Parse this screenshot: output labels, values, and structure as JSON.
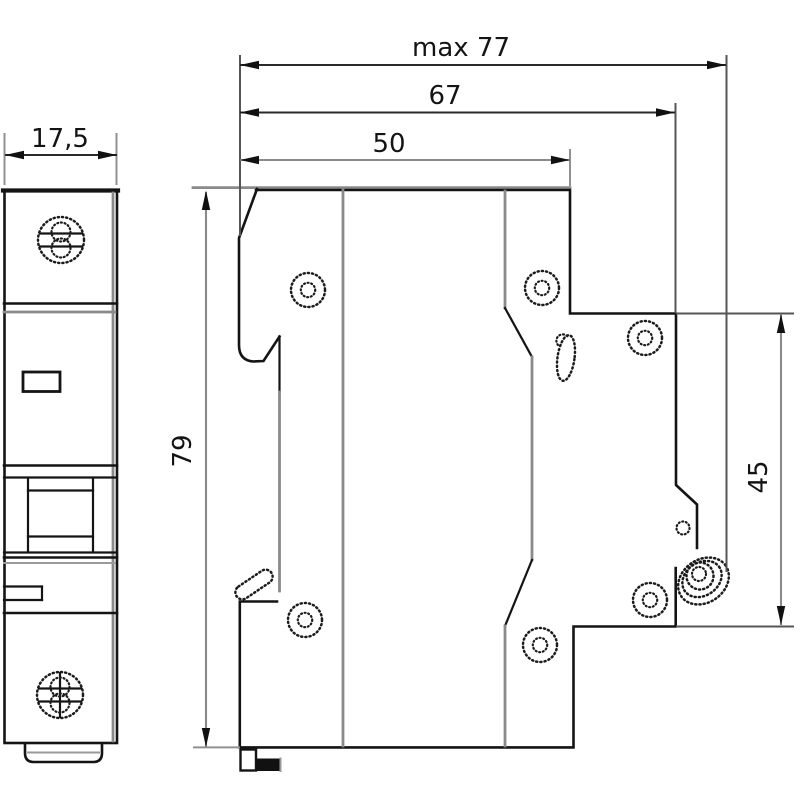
{
  "drawing": {
    "title": "Modular circuit breaker — outline and mounting dimensions",
    "type": "technical-drawing",
    "units": "mm",
    "views": {
      "front": {
        "name": "front-view"
      },
      "side": {
        "name": "side-view"
      }
    },
    "dimensions": {
      "front_width": "17,5",
      "max_depth": "max 77",
      "body_depth": "67",
      "upper_depth": "50",
      "height": "79",
      "front_height": "45"
    },
    "colors": {
      "line": "#141414",
      "secondary_line": "#8a8a8a",
      "background": "#ffffff"
    }
  }
}
